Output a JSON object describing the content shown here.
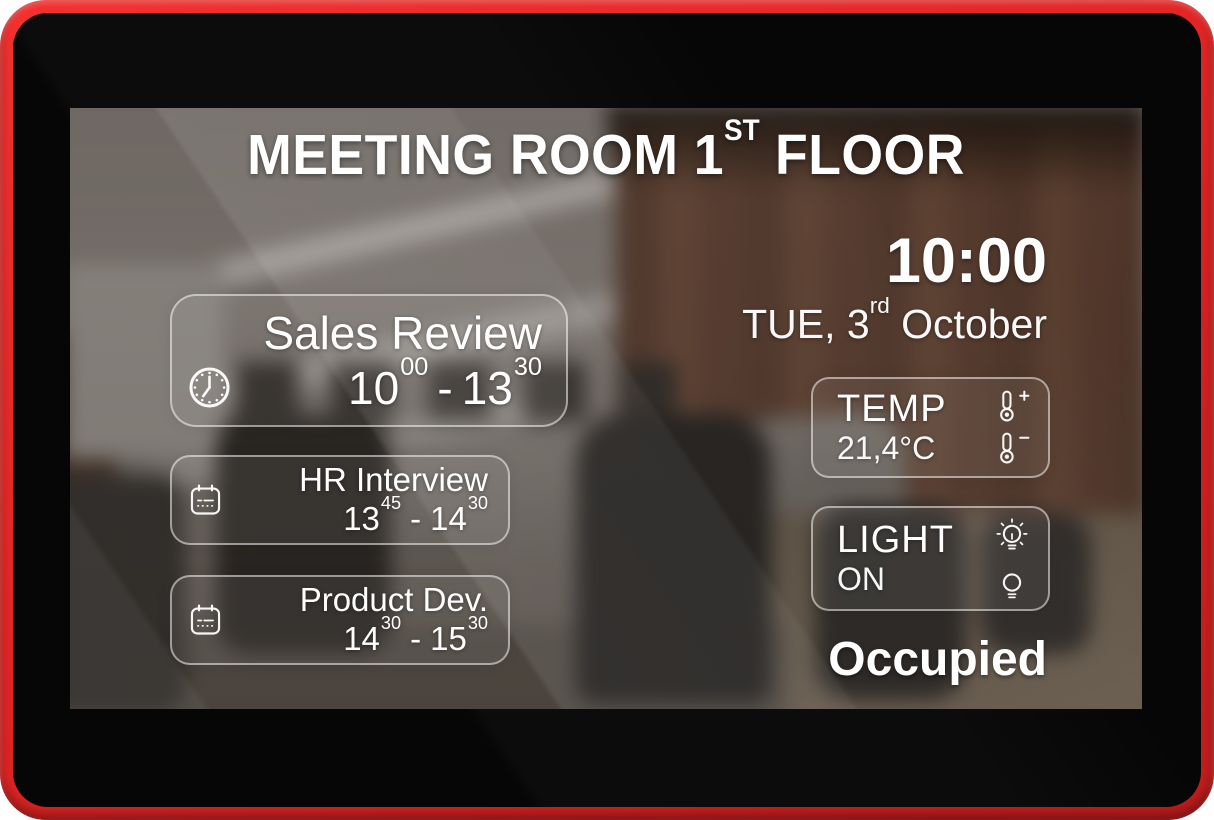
{
  "header": {
    "title_prefix": "MEETING ROOM 1",
    "title_ordinal": "ST",
    "title_suffix": " FLOOR"
  },
  "clock": {
    "time": "10:00",
    "date_prefix": "TUE, 3",
    "date_ordinal": "rd",
    "date_suffix": " October"
  },
  "ui": {
    "time_separator": "-"
  },
  "events": [
    {
      "name": "Sales Review",
      "icon": "clock-icon",
      "start_hour": "10",
      "start_min": "00",
      "end_hour": "13",
      "end_min": "30"
    },
    {
      "name": "HR Interview",
      "icon": "calendar-icon",
      "start_hour": "13",
      "start_min": "45",
      "end_hour": "14",
      "end_min": "30"
    },
    {
      "name": "Product Dev.",
      "icon": "calendar-icon",
      "start_hour": "14",
      "start_min": "30",
      "end_hour": "15",
      "end_min": "30"
    }
  ],
  "widgets": {
    "temp": {
      "label": "TEMP",
      "value": "21,4°C",
      "increase_icon": "thermometer-plus-icon",
      "decrease_icon": "thermometer-minus-icon"
    },
    "light": {
      "label": "LIGHT",
      "value": "ON",
      "on_icon": "light-on-icon",
      "off_icon": "light-off-icon"
    }
  },
  "status": {
    "label": "Occupied"
  },
  "colors": {
    "frame_red": "#e12626",
    "bezel_black": "#060606",
    "text_white": "#ffffff"
  }
}
